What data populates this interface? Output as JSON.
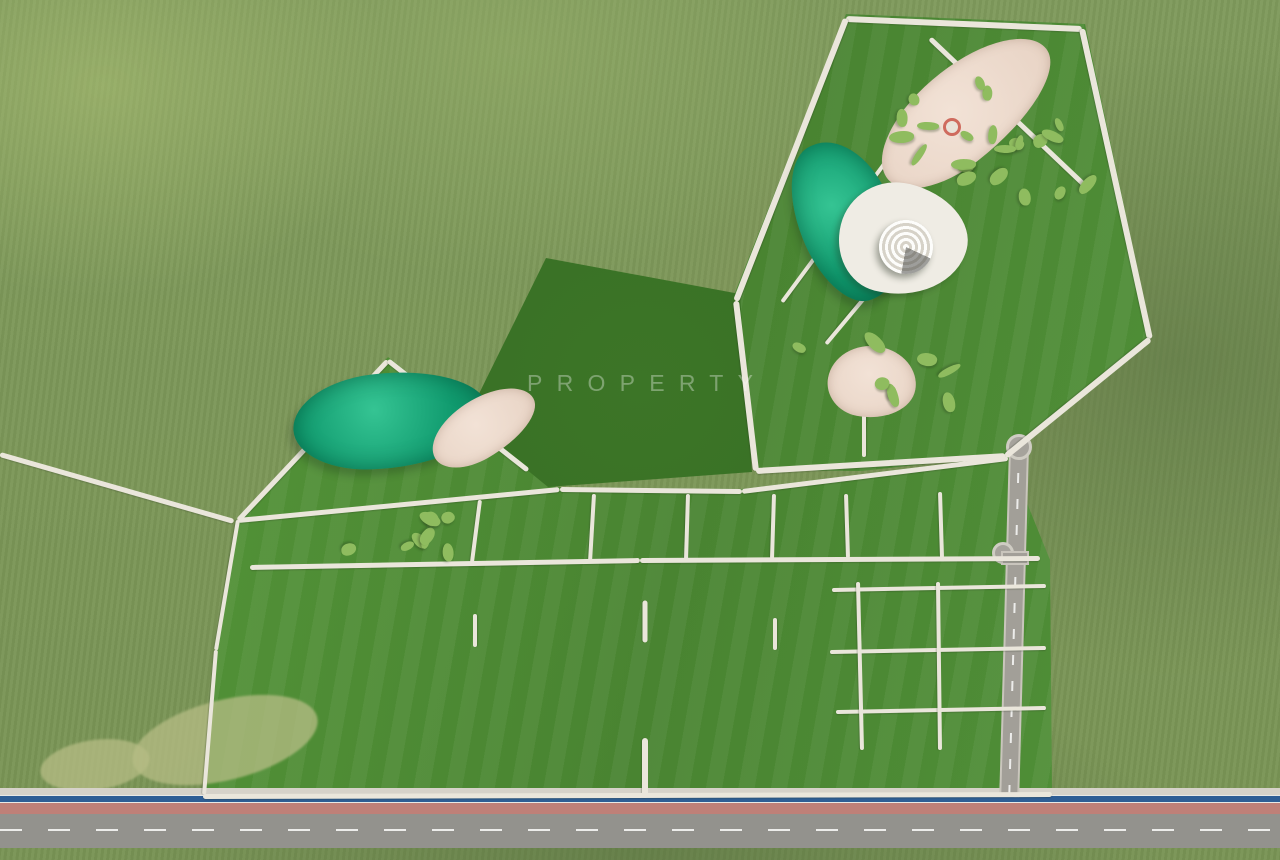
{
  "watermark": {
    "title": "STATUS",
    "subtitle": "PROPERTY"
  },
  "palette": {
    "lawn": "#4f8d33",
    "field": "#7f9a5c",
    "pond_water": "#12a377",
    "pool_water": "#31bae6",
    "bike_lane_blue": "#2e5e95",
    "walkway": "#eae6db",
    "sand": "#eedacd",
    "asphalt": "#93928d",
    "lane_pink": "#bf8078",
    "court_red": "#8f4038",
    "court_pink": "#d57f74",
    "court_tennis": "#b8d275",
    "building_white": "#f2f1ed",
    "watermark_white": "#ffffff"
  },
  "scene": {
    "regions": [
      {
        "name": "park-northeast-lawn",
        "cls": "lawn",
        "pts": [
          [
            846,
            14
          ],
          [
            1085,
            24
          ],
          [
            1152,
            336
          ],
          [
            1008,
            455
          ],
          [
            862,
            471
          ],
          [
            753,
            470
          ],
          [
            734,
            295
          ]
        ]
      },
      {
        "name": "west-pond-lawn",
        "cls": "lawn",
        "pts": [
          [
            238,
            518
          ],
          [
            388,
            357
          ],
          [
            530,
            469
          ],
          [
            556,
            487
          ],
          [
            242,
            522
          ]
        ]
      },
      {
        "name": "main-residential-lawn",
        "cls": "lawn",
        "pts": [
          [
            238,
            518
          ],
          [
            556,
            487
          ],
          [
            742,
            489
          ],
          [
            1008,
            456
          ],
          [
            1050,
            560
          ],
          [
            1052,
            792
          ],
          [
            204,
            792
          ],
          [
            216,
            646
          ]
        ]
      },
      {
        "name": "central-grove",
        "cls": "grove",
        "pts": [
          [
            546,
            258
          ],
          [
            740,
            294
          ],
          [
            752,
            472
          ],
          [
            548,
            487
          ],
          [
            466,
            420
          ]
        ]
      }
    ],
    "patches": [
      [
        130,
        700,
        190,
        80,
        -14
      ],
      [
        40,
        740,
        110,
        50,
        -8
      ]
    ],
    "ponds": [
      [
        390,
        420,
        195,
        95,
        -4
      ],
      [
        846,
        220,
        95,
        165,
        -24
      ]
    ],
    "sands": [
      [
        483,
        427,
        115,
        58,
        -30
      ],
      [
        965,
        112,
        205,
        92,
        -38
      ],
      [
        872,
        382,
        88,
        72,
        10
      ]
    ],
    "plaza_blob": [
      903,
      240,
      128,
      112,
      14
    ],
    "amphitheater": [
      906,
      247,
      27
    ],
    "carousels": [
      [
        952,
        127
      ],
      [
        1037,
        167
      ],
      [
        866,
        378
      ]
    ],
    "playshape_clusters": [
      [
        952,
        127,
        11,
        7
      ],
      [
        1037,
        167,
        11,
        8
      ],
      [
        866,
        382,
        8,
        9
      ],
      [
        440,
        535,
        5,
        4
      ],
      [
        390,
        535,
        4,
        5
      ]
    ],
    "courts": [
      {
        "type": "basket_pink",
        "x": 533,
        "y": 529,
        "w": 84,
        "h": 48,
        "rot": -33
      },
      {
        "type": "basket_red",
        "x": 634,
        "y": 526,
        "w": 76,
        "h": 44,
        "rot": -6
      },
      {
        "type": "tennis",
        "x": 731,
        "y": 531,
        "w": 70,
        "h": 44,
        "rot": -3
      },
      {
        "type": "gazebo",
        "x": 803,
        "y": 533,
        "w": 58,
        "h": 50,
        "rot": -3
      },
      {
        "type": "basket_pink",
        "x": 967,
        "y": 356,
        "w": 80,
        "h": 46,
        "rot": -33
      }
    ],
    "paths": [
      [
        846,
        16,
        1082,
        26,
        6
      ],
      [
        1082,
        26,
        1150,
        336,
        6
      ],
      [
        1150,
        336,
        1006,
        453,
        6
      ],
      [
        736,
        298,
        846,
        16,
        6
      ],
      [
        736,
        298,
        756,
        468,
        6
      ],
      [
        756,
        468,
        1006,
        453,
        6
      ],
      [
        933,
        96,
        906,
        246,
        4
      ],
      [
        906,
        246,
        826,
        342,
        4
      ],
      [
        782,
        300,
        933,
        96,
        4
      ],
      [
        864,
        455,
        864,
        390,
        4
      ],
      [
        930,
        36,
        1088,
        186,
        5
      ],
      [
        238,
        518,
        388,
        358,
        5
      ],
      [
        388,
        358,
        528,
        468,
        5
      ],
      [
        0,
        452,
        234,
        519,
        5
      ],
      [
        238,
        518,
        560,
        487,
        5
      ],
      [
        560,
        487,
        742,
        489,
        5
      ],
      [
        742,
        489,
        1008,
        456,
        5
      ],
      [
        480,
        498,
        472,
        560,
        4
      ],
      [
        594,
        492,
        590,
        560,
        4
      ],
      [
        688,
        492,
        686,
        558,
        4
      ],
      [
        774,
        492,
        772,
        557,
        4
      ],
      [
        846,
        492,
        848,
        556,
        4
      ],
      [
        940,
        490,
        942,
        556,
        4
      ],
      [
        250,
        565,
        640,
        558,
        5
      ],
      [
        640,
        558,
        1040,
        556,
        5
      ],
      [
        832,
        588,
        1046,
        584,
        4
      ],
      [
        830,
        650,
        1046,
        646,
        4
      ],
      [
        836,
        710,
        1046,
        706,
        4
      ],
      [
        858,
        580,
        862,
        748,
        4
      ],
      [
        938,
        580,
        940,
        748,
        4
      ],
      [
        645,
        598,
        645,
        640,
        5
      ],
      [
        645,
        735,
        645,
        795,
        6
      ],
      [
        475,
        645,
        475,
        612,
        4
      ],
      [
        775,
        648,
        775,
        616,
        4
      ],
      [
        203,
        794,
        1052,
        792,
        5
      ],
      [
        238,
        518,
        216,
        648,
        4
      ],
      [
        216,
        648,
        204,
        793,
        4
      ]
    ],
    "river": [
      [
        293,
        656,
        362,
        641
      ],
      [
        362,
        641,
        452,
        618
      ],
      [
        452,
        618,
        543,
        603
      ],
      [
        543,
        603,
        612,
        597
      ],
      [
        676,
        598,
        744,
        622
      ],
      [
        744,
        622,
        800,
        645
      ],
      [
        800,
        645,
        1046,
        644
      ]
    ],
    "plaza_ring": [
      645,
      687,
      216,
      132
    ],
    "pools": [
      {
        "x": 475,
        "y": 690,
        "w": 120,
        "h": 78,
        "ringw": 154,
        "ringh": 106
      },
      {
        "x": 775,
        "y": 688,
        "w": 100,
        "h": 66,
        "ringw": 130,
        "ringh": 92
      }
    ],
    "club": {
      "x": 645,
      "y": 687,
      "w": 178,
      "h": 96
    },
    "buildings": [
      [
        343,
        607,
        102,
        62,
        -18
      ],
      [
        421,
        600,
        74,
        48,
        -15
      ],
      [
        308,
        681,
        102,
        62,
        -22
      ],
      [
        398,
        686,
        66,
        76,
        -4
      ],
      [
        364,
        690,
        58,
        72,
        -8,
        "pink"
      ],
      [
        557,
        622,
        94,
        58,
        -6
      ],
      [
        633,
        617,
        90,
        56,
        -2
      ],
      [
        709,
        621,
        90,
        56,
        2
      ],
      [
        871,
        597,
        106,
        62,
        4
      ],
      [
        993,
        610,
        102,
        64,
        6
      ],
      [
        889,
        687,
        96,
        74,
        8
      ],
      [
        1014,
        690,
        92,
        72,
        8
      ]
    ],
    "row_buildings": [
      [
        247,
        782
      ],
      [
        333,
        780
      ],
      [
        420,
        779
      ],
      [
        501,
        777
      ],
      [
        578,
        776
      ],
      [
        682,
        778
      ],
      [
        755,
        776
      ],
      [
        830,
        775
      ],
      [
        903,
        773
      ],
      [
        972,
        771
      ],
      [
        1040,
        769
      ]
    ],
    "row_size": [
      95,
      52
    ],
    "shadow_bands_extra": [
      100,
      168
    ],
    "tree_rows": [
      [
        6,
        450,
        228,
        515,
        13,
        8,
        "tree-field"
      ],
      [
        243,
        514,
        384,
        362,
        10,
        7,
        "tree-sage"
      ],
      [
        392,
        362,
        524,
        464,
        9,
        7,
        "tree-sage"
      ],
      [
        740,
        294,
        842,
        22,
        9,
        7,
        "tree-sage"
      ],
      [
        850,
        18,
        1078,
        28,
        10,
        7,
        "tree-sage"
      ],
      [
        1086,
        30,
        1148,
        332,
        10,
        7,
        "tree-sage"
      ],
      [
        760,
        464,
        1000,
        452,
        8,
        6,
        "tree-sage"
      ],
      [
        934,
        40,
        1084,
        184,
        8,
        7,
        "tree-sage"
      ],
      [
        480,
        495,
        1005,
        462,
        12,
        5,
        "tree-sage"
      ],
      [
        260,
        562,
        1038,
        556,
        14,
        5,
        "tree-sage"
      ],
      [
        250,
        520,
        520,
        478,
        8,
        5,
        "tree-sage"
      ],
      [
        834,
        586,
        1044,
        582,
        6,
        5,
        "tree-sage"
      ],
      [
        1042,
        470,
        1048,
        700,
        8,
        5,
        "tree-sage"
      ],
      [
        240,
        753,
        1040,
        747,
        16,
        7,
        "palm"
      ],
      [
        585,
        737,
        710,
        737,
        4,
        6,
        "palm"
      ],
      [
        585,
        641,
        710,
        641,
        4,
        6,
        "palm"
      ]
    ],
    "tree_scatter": [
      [
        0,
        0,
        1280,
        800,
        215,
        7,
        13,
        "tree-field",
        7,
        1
      ],
      [
        548,
        300,
        200,
        180,
        20,
        6,
        10,
        "tree-field",
        11,
        0
      ],
      [
        770,
        60,
        340,
        380,
        16,
        5,
        8,
        "tree-sage",
        23,
        0
      ],
      [
        0,
        842,
        1280,
        16,
        8,
        5,
        8,
        "tree-field",
        31,
        0
      ]
    ],
    "avoid": [
      [
        196,
        450,
        870,
        410
      ],
      [
        726,
        8,
        434,
        462
      ],
      [
        228,
        348,
        320,
        176
      ],
      [
        0,
        786,
        1280,
        74
      ]
    ],
    "pool_palm_angles": [
      20,
      70,
      110,
      160,
      205,
      250,
      310
    ],
    "court_palms": [
      [
        512,
        512
      ],
      [
        556,
        548
      ],
      [
        948,
        340
      ],
      [
        988,
        372
      ]
    ],
    "roads": {
      "band": {
        "sidewalk_y": 788,
        "blue_y": 795,
        "pink_y": 803,
        "asphalt_y": 814,
        "asphalt_h": 34,
        "dash_y": 829
      },
      "vertical": {
        "x": 1019,
        "top": 447,
        "bottom": 795,
        "w": 16,
        "tilt": 1.6
      },
      "culdesacs": [
        [
          1019,
          447,
          13
        ],
        [
          1003,
          553,
          11
        ]
      ],
      "stub": [
        1003,
        553,
        1027,
        553,
        10
      ]
    },
    "cars": [
      [
        50,
        827,
        "#3a3a3a",
        16
      ],
      [
        230,
        824,
        "#e8e8e6",
        15
      ],
      [
        504,
        828,
        "#2c2c2c",
        17
      ],
      [
        674,
        822,
        "#dcdcda",
        19
      ],
      [
        764,
        831,
        "#3f3f42",
        15
      ],
      [
        934,
        821,
        "#e4e4e2",
        18
      ],
      [
        1118,
        826,
        "#35353a",
        16
      ]
    ],
    "gate": [
      632,
      766
    ]
  }
}
